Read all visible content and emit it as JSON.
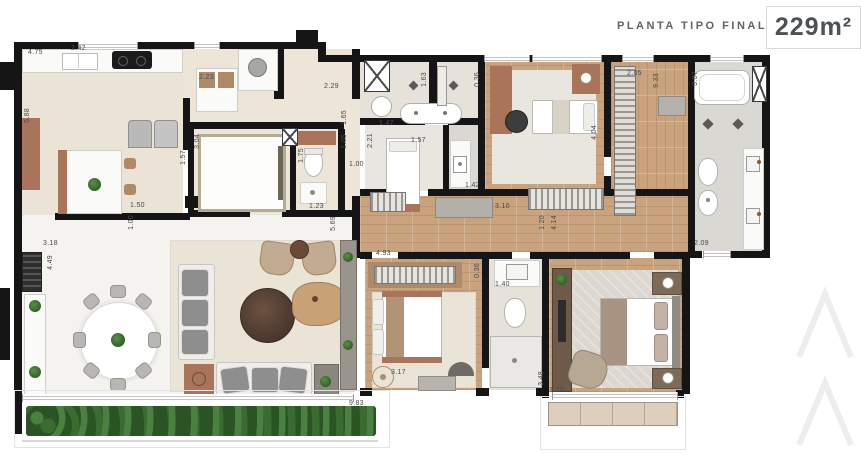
{
  "header": {
    "title": "PLANTA TIPO FINAL 2",
    "area_label": "229m²"
  },
  "watermark": {
    "icon": "double-chevron",
    "color": "#ededed"
  },
  "colors": {
    "wall": "#151515",
    "wood_floor": "#c8a37d",
    "marble_floor": "#f5f3f0",
    "rug_beige": "#eae4d7",
    "plant_green": "#2f5d28",
    "title_gray": "#5f6468",
    "area_box_border": "#d9d9d9"
  },
  "dimensions": [
    {
      "t": "4.75",
      "x": 28,
      "y": 49,
      "v": 0
    },
    {
      "t": "2.42",
      "x": 71,
      "y": 45,
      "v": 0
    },
    {
      "t": "5.88",
      "x": 24,
      "y": 108,
      "v": 1
    },
    {
      "t": "2.23",
      "x": 199,
      "y": 74,
      "v": 0
    },
    {
      "t": "2.29",
      "x": 324,
      "y": 83,
      "v": 0
    },
    {
      "t": "3.04",
      "x": 194,
      "y": 134,
      "v": 1
    },
    {
      "t": "1.57",
      "x": 180,
      "y": 150,
      "v": 1
    },
    {
      "t": "1.65",
      "x": 341,
      "y": 110,
      "v": 1
    },
    {
      "t": "1.05",
      "x": 341,
      "y": 134,
      "v": 1
    },
    {
      "t": "1.75",
      "x": 298,
      "y": 148,
      "v": 1
    },
    {
      "t": "1.00",
      "x": 349,
      "y": 161,
      "v": 0
    },
    {
      "t": "1.23",
      "x": 309,
      "y": 203,
      "v": 0
    },
    {
      "t": "5.69",
      "x": 330,
      "y": 216,
      "v": 1
    },
    {
      "t": "1.63",
      "x": 421,
      "y": 72,
      "v": 1
    },
    {
      "t": "0.36",
      "x": 474,
      "y": 72,
      "v": 1
    },
    {
      "t": "1.47",
      "x": 379,
      "y": 120,
      "v": 0
    },
    {
      "t": "2.21",
      "x": 367,
      "y": 133,
      "v": 1
    },
    {
      "t": "1.57",
      "x": 411,
      "y": 137,
      "v": 0
    },
    {
      "t": "1.42",
      "x": 465,
      "y": 182,
      "v": 0
    },
    {
      "t": "2.05",
      "x": 627,
      "y": 70,
      "v": 0
    },
    {
      "t": "9.33",
      "x": 653,
      "y": 73,
      "v": 1
    },
    {
      "t": "3.07",
      "x": 692,
      "y": 71,
      "v": 1
    },
    {
      "t": "4.04",
      "x": 591,
      "y": 125,
      "v": 1
    },
    {
      "t": "3.10",
      "x": 495,
      "y": 203,
      "v": 0
    },
    {
      "t": "1.20",
      "x": 539,
      "y": 215,
      "v": 1
    },
    {
      "t": "4.14",
      "x": 551,
      "y": 215,
      "v": 1
    },
    {
      "t": "2.09",
      "x": 694,
      "y": 240,
      "v": 0
    },
    {
      "t": "1.50",
      "x": 130,
      "y": 202,
      "v": 0
    },
    {
      "t": "1.00",
      "x": 128,
      "y": 215,
      "v": 1
    },
    {
      "t": "3.18",
      "x": 43,
      "y": 240,
      "v": 0
    },
    {
      "t": "4.49",
      "x": 47,
      "y": 255,
      "v": 1
    },
    {
      "t": "4.93",
      "x": 376,
      "y": 250,
      "v": 0
    },
    {
      "t": "0.36",
      "x": 474,
      "y": 263,
      "v": 1
    },
    {
      "t": "1.40",
      "x": 495,
      "y": 281,
      "v": 0
    },
    {
      "t": "3.17",
      "x": 391,
      "y": 369,
      "v": 0
    },
    {
      "t": "3.48",
      "x": 538,
      "y": 371,
      "v": 1
    },
    {
      "t": "3.70",
      "x": 549,
      "y": 387,
      "v": 0
    },
    {
      "t": "9.83",
      "x": 349,
      "y": 400,
      "v": 0
    }
  ]
}
